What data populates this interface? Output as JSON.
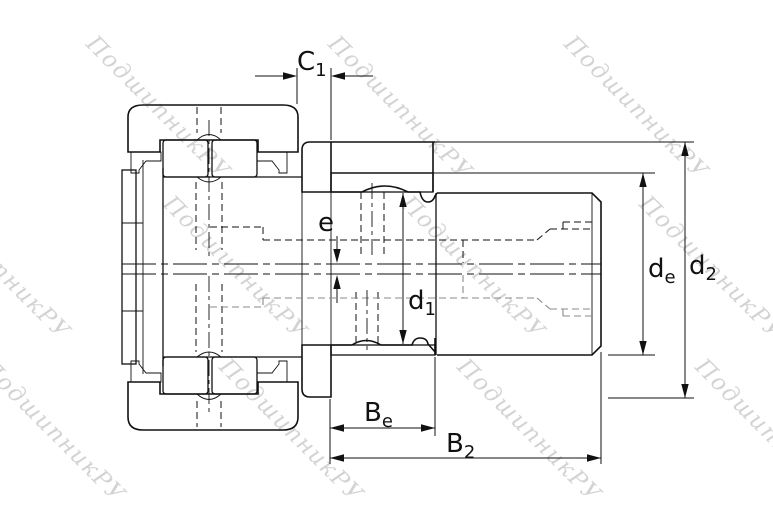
{
  "drawing": {
    "background": "#ffffff",
    "line_color": "#111111",
    "hidden_line_gray": "#8a8a8a",
    "dimension_labels": [
      {
        "id": "c1",
        "base": "C",
        "sub": "1"
      },
      {
        "id": "e",
        "base": "e",
        "sub": ""
      },
      {
        "id": "d1",
        "base": "d",
        "sub": "1"
      },
      {
        "id": "de",
        "base": "d",
        "sub": "e"
      },
      {
        "id": "d2",
        "base": "d",
        "sub": "2"
      },
      {
        "id": "be",
        "base": "B",
        "sub": "e"
      },
      {
        "id": "b2",
        "base": "B",
        "sub": "2"
      }
    ]
  },
  "watermark": {
    "text": "ПодшипникРУ",
    "color": "#a9a9a9"
  }
}
